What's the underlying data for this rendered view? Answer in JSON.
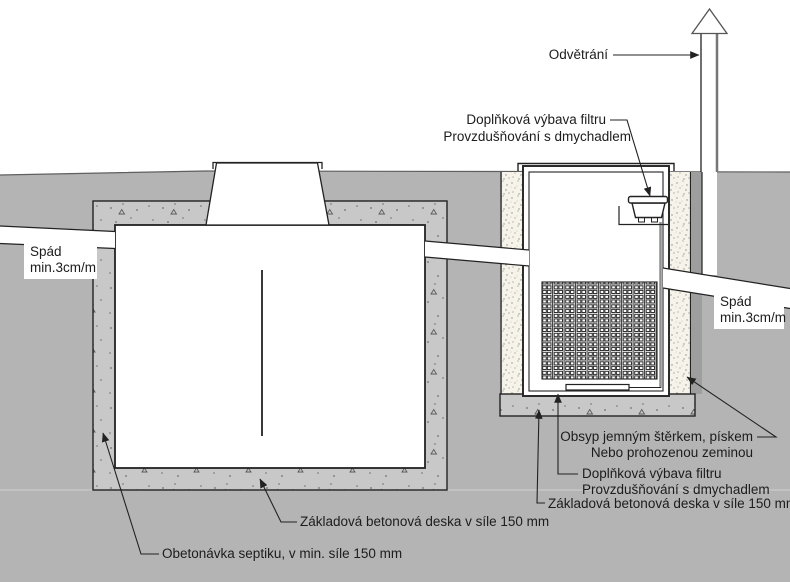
{
  "labels": {
    "vent": "Odvětrání",
    "filter_equipment_top": {
      "line1": "Doplňková výbava filtru",
      "line2": "Provzdušňování s dmychadlem"
    },
    "slope_left": {
      "line1": "Spád",
      "line2": "min.3cm/m"
    },
    "slope_right": {
      "line1": "Spád",
      "line2": "min.3cm/m"
    },
    "backfill": {
      "line1": "Obsyp jemným štěrkem, pískem",
      "line2": "Nebo prohozenou zeminou"
    },
    "filter_equipment_bottom": {
      "line1": "Doplňková výbava filtru",
      "line2": "Provzdušňování s dmychadlem"
    },
    "base_slab_filter": "Základová betonová deska v síle 150 mm",
    "base_slab_septic": "Základová betonová deska v síle 150 mm",
    "encasement": "Obetonávka septiku, v min. síle 150 mm"
  },
  "colors": {
    "background": "#ffffff",
    "ground": "#b4b4b4",
    "concrete": "#c8c8c8",
    "backfill_sand": "#f6f3ea",
    "outline": "#222222",
    "pipe_shadow": "#9e9e9e",
    "vent_pipe_edge": "#777777",
    "label_text": "#1c1c1c"
  }
}
